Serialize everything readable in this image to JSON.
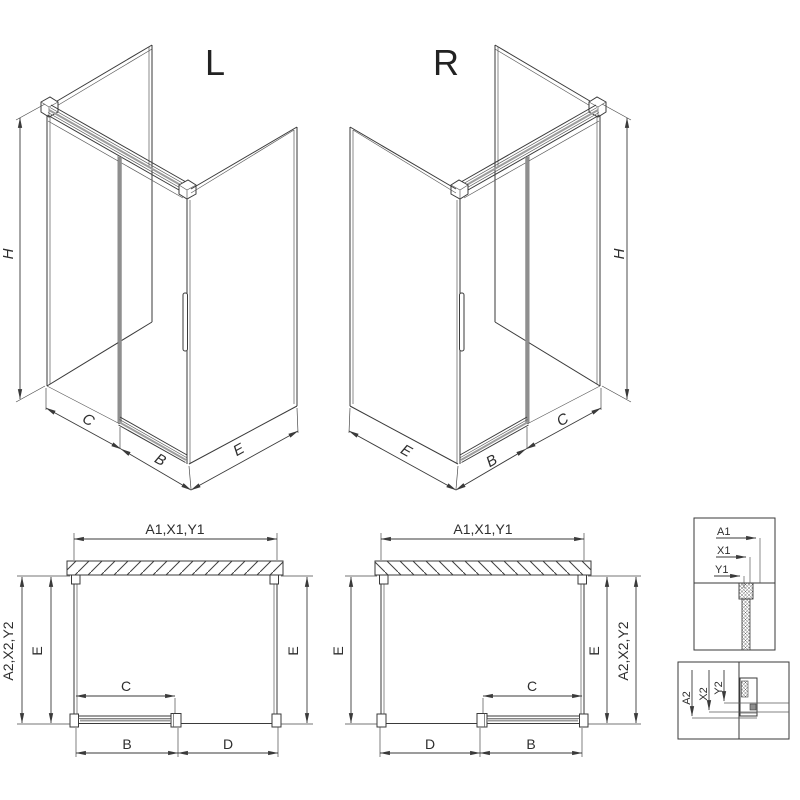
{
  "drawing": {
    "iso_left": {
      "view_label": "L",
      "dim_height": "H",
      "dim_fixed": "C",
      "dim_door": "B",
      "dim_side": "E"
    },
    "iso_right": {
      "view_label": "R",
      "dim_height": "H",
      "dim_side": "E",
      "dim_door": "B",
      "dim_fixed": "C"
    },
    "plan_left": {
      "dim_width_top": "A1,X1,Y1",
      "dim_depth_outer": "A2,X2,Y2",
      "dim_depth_inner": "E",
      "dim_depth_right": "E",
      "dim_fixed": "C",
      "dim_door": "B",
      "dim_opening": "D"
    },
    "plan_right": {
      "dim_width_top": "A1,X1,Y1",
      "dim_depth_left": "E",
      "dim_fixed": "C",
      "dim_opening": "D",
      "dim_door": "B",
      "dim_depth_inner": "E",
      "dim_depth_outer": "A2,X2,Y2"
    },
    "detail_wall_profile": {
      "labels": [
        "A1",
        "X1",
        "Y1"
      ]
    },
    "detail_floor_profile": {
      "labels": [
        "A2",
        "X2",
        "Y2"
      ]
    },
    "colors": {
      "line": "#3a3a3a",
      "gray_accent": "#8f8f8f",
      "background": "#ffffff"
    }
  }
}
